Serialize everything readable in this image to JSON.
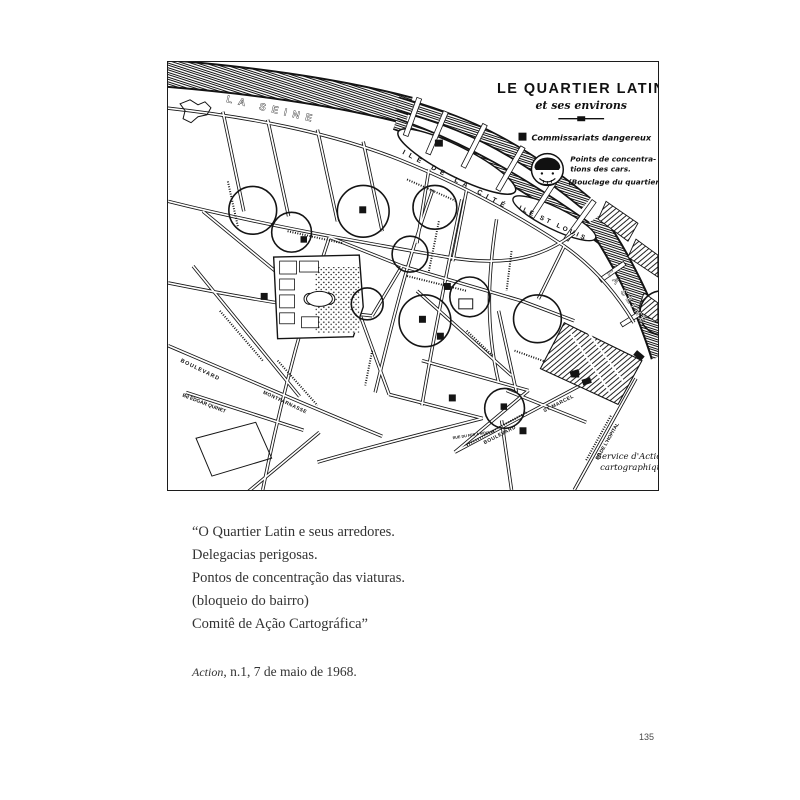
{
  "theme": {
    "ink": "#1c1c1c",
    "paper": "#ffffff",
    "caption_text": "#333333"
  },
  "page": {
    "number": "135"
  },
  "map": {
    "title": "LE QUARTIER LATIN",
    "subtitle": "et ses environs",
    "legend": {
      "square_label": "Commissariats dangereux",
      "police_icon": "police-head-icon",
      "points_line1": "Points de concentra-",
      "points_line2": "tions des cars.",
      "points_line3": "(Bouclage du quartier)"
    },
    "credit_line1": "Service d'Action",
    "credit_line2": "cartographique",
    "labels": {
      "seine_top": "LA  SEINE",
      "seine_right": "LA SEINE",
      "ile_cite": "ILE DE LA CITÉ",
      "ile_st_louis": "ILE ST LOUIS",
      "boulevard_left": "BOULEVARD",
      "edgar_quinet": "Bd EDGAR QUINET",
      "montparnasse": "MONTPARNASSE",
      "st_marcel_1": "BOULEVARD",
      "st_marcel_2": "ST MARCEL",
      "hopital": "Bd DE L'HOPITAL",
      "fer_a_moulin": "RUE DU FER A MOULIN"
    }
  },
  "caption": {
    "line1": "“O Quartier Latin e seus arredores.",
    "line2": "Delegacias perigosas.",
    "line3": "Pontos de concentração das viaturas.",
    "line4": "(bloqueio do bairro)",
    "line5": "Comitê de Ação Cartográfica”",
    "source_title": "Action",
    "source_rest": ", n.1, 7 de maio de 1968."
  }
}
